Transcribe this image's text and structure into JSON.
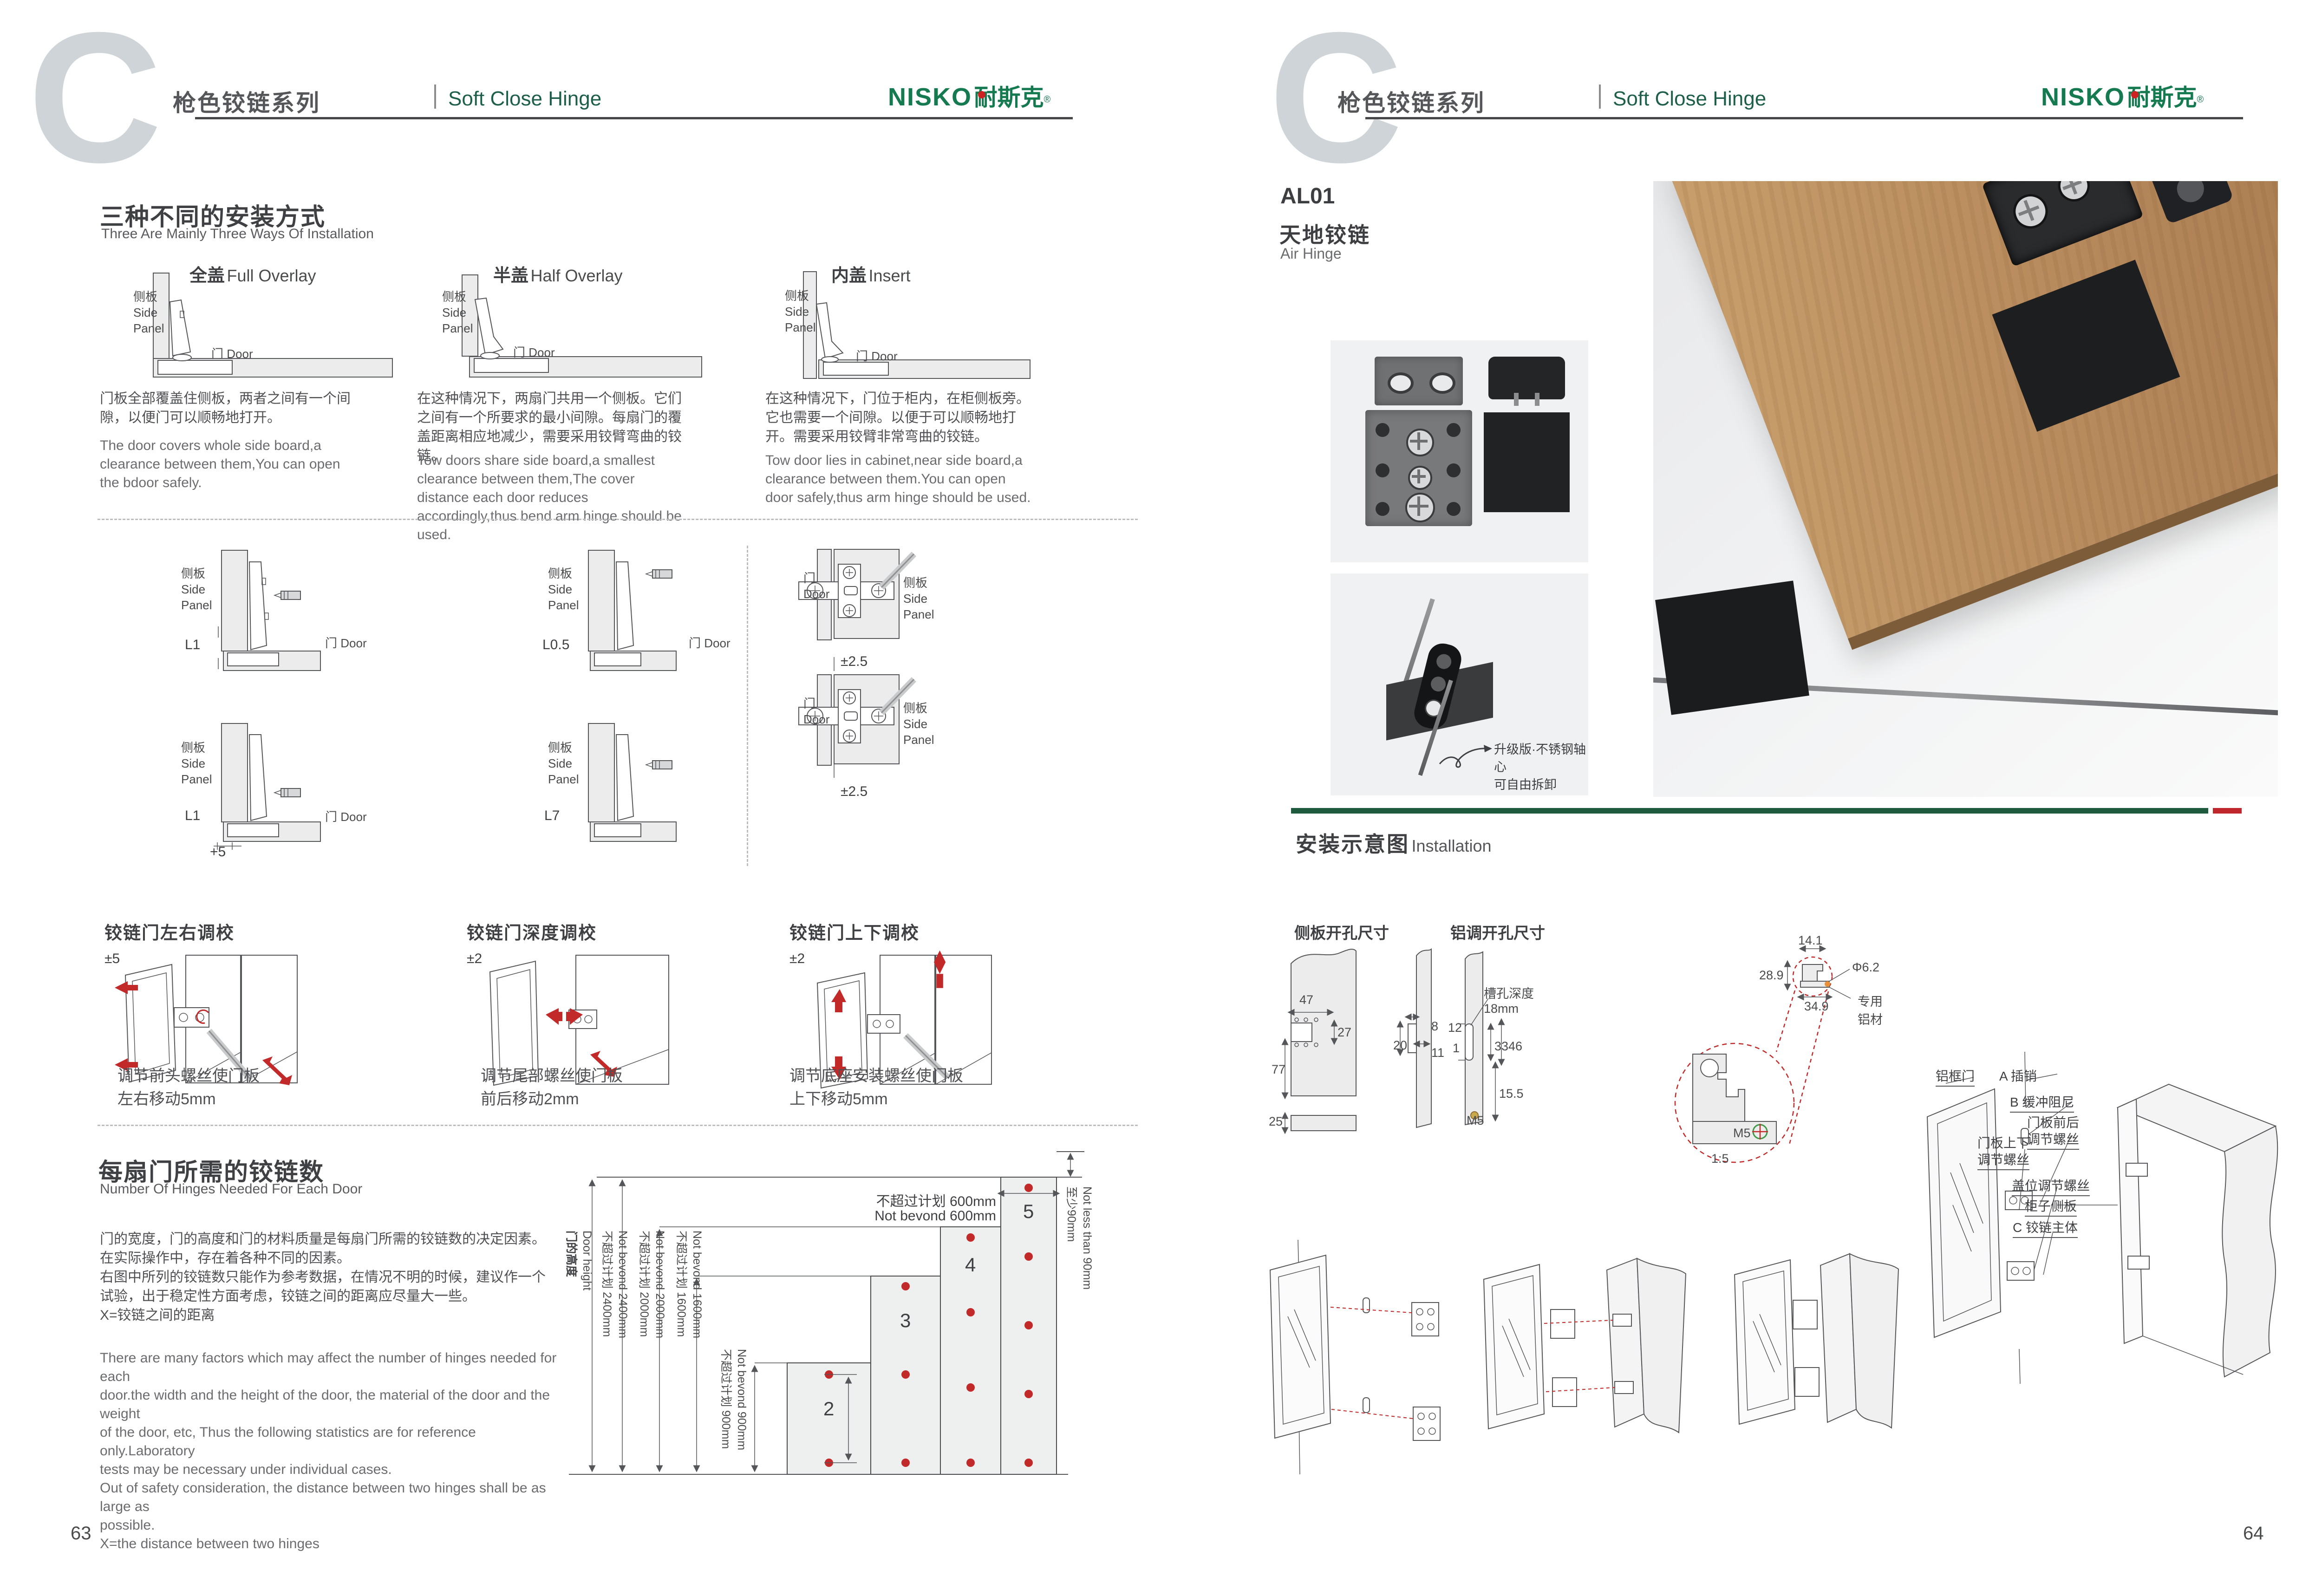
{
  "header": {
    "letter": "C",
    "title_cn": "枪色铰链系列",
    "title_en": "Soft Close Hinge",
    "brand_en": "NISKO",
    "brand_cn": "耐斯克",
    "brand_reg": "®"
  },
  "labels": {
    "side_panel_cn": "侧板",
    "side_panel_en1": "Side",
    "side_panel_en2": "Panel",
    "door_cn": "门",
    "door_en": "Door"
  },
  "install": {
    "title_cn": "三种不同的安装方式",
    "title_en": "Three Are Mainly Three Ways Of Installation",
    "methods": [
      {
        "title_cn": "全盖",
        "title_en": "Full Overlay",
        "desc_cn": "门板全部覆盖住侧板，两者之间有一个间隙，以便门可以顺畅地打开。",
        "desc_en": "The door covers whole side board,a clearance between them,You can open the bdoor safely."
      },
      {
        "title_cn": "半盖",
        "title_en": "Half Overlay",
        "desc_cn": "在这种情况下，两扇门共用一个侧板。它们之间有一个所要求的最小间隙。每扇门的覆盖距离相应地减少，需要采用铰臂弯曲的铰链。",
        "desc_en": "Tow doors share side board,a smallest clearance between them,The cover distance each door reduces accordingly,thus bend arm hinge should be used."
      },
      {
        "title_cn": "内盖",
        "title_en": "Insert",
        "desc_cn": "在这种情况下，门位于柜内，在柜侧板旁。它也需要一个间隙。以便于可以顺畅地打开。需要采用铰臂非常弯曲的铰链。",
        "desc_en": "Tow door lies in cabinet,near side board,a clearance between them.You can open door safely,thus arm hinge should be used."
      }
    ]
  },
  "clearance": {
    "l1": "L1",
    "l05": "L0.5",
    "l7": "L7",
    "plus5": "+5",
    "pm25": "±2.5"
  },
  "adjust": {
    "items": [
      {
        "title": "铰链门左右调校",
        "range": "±5",
        "cap1": "调节前头螺丝使门板",
        "cap2": "左右移动5mm"
      },
      {
        "title": "铰链门深度调校",
        "range": "±2",
        "cap1": "调节尾部螺丝使门板",
        "cap2": "前后移动2mm"
      },
      {
        "title": "铰链门上下调校",
        "range": "±2",
        "cap1": "调节底座安装螺丝使门板",
        "cap2": "上下移动5mm"
      }
    ]
  },
  "hinges": {
    "title_cn": "每扇门所需的铰链数",
    "title_en": "Number Of Hinges Needed For Each Door",
    "cn_lines": [
      "门的宽度，门的高度和门的材料质量是每扇门所需的铰链数的决定因素。",
      "在实际操作中，存在着各种不同的因素。",
      "右图中所列的铰链数只能作为参考数据，在情况不明的时候，建议作一个",
      "试验，出于稳定性方面考虑，铰链之间的距离应尽量大一些。",
      "X=铰链之间的距离"
    ],
    "en_lines": [
      "There are many factors which may affect the number of hinges needed for each",
      "door.the width and the height of the door, the material of the door and the weight",
      "of the door, etc, Thus the following statistics are for reference only.Laboratory",
      "tests may be necessary under individual cases.",
      "Out of safety consideration, the distance between two hinges shall be as large as",
      "possible.",
      "X=the distance between two hinges"
    ]
  },
  "chart": {
    "door_height_cn": "门的高度",
    "door_height_en": "Door height",
    "h2400_cn": "不超过计划 2400mm",
    "h2400_en": "Not bevond 2400mm",
    "h2000_cn": "不超过计划 2000mm",
    "h2000_en": "Not bevond 2000mm",
    "h1600_cn": "不超过计划 1600mm",
    "h1600_en": "Not bevond 1600mm",
    "h900_cn": "不超过计划 900mm",
    "h900_en": "Not bevond 900mm",
    "w600_cn": "不超过计划 600mm",
    "w600_en": "Not bevond 600mm",
    "min90_cn": "至少90mm",
    "min90_en": "Not less than 90mm",
    "n2": "2",
    "n3": "3",
    "n4": "4",
    "n5": "5"
  },
  "chart_data": {
    "type": "bar",
    "title": "Number Of Hinges Needed For Each Door",
    "categories": [
      "Not bevond 900mm",
      "Not bevond 1600mm",
      "Not bevond 2000mm",
      "Not bevond 2400mm"
    ],
    "values": [
      2,
      3,
      4,
      5
    ],
    "xlabel": "Door width not bevond 600mm",
    "ylabel": "Door height",
    "notes": [
      "Top hinge not less than 90mm from door edge",
      "X=the distance between two hinges"
    ]
  },
  "product": {
    "code": "AL01",
    "name_cn": "天地铰链",
    "name_en": "Air Hinge",
    "photo_note1": "升级版·不锈钢轴心",
    "photo_note2": "可自由拆卸"
  },
  "installation": {
    "title_cn": "安装示意图",
    "title_en": "Installation",
    "side_title": "侧板开孔尺寸",
    "alu_title": "铝调开孔尺寸",
    "d47": "47",
    "d27": "27",
    "d77": "77",
    "d25": "25",
    "d8": "8",
    "d20": "20",
    "d11": "11",
    "d12": "12",
    "d1": "1",
    "d33": "33",
    "d46": "46",
    "d155": "15.5",
    "m5": "M5",
    "slot_note1": "槽孔深度",
    "slot_note2": "18mm",
    "d141": "14.1",
    "d289": "28.9",
    "d349": "34.9",
    "dia62": "Φ6.2",
    "alu_mat1": "专用",
    "alu_mat2": "铝材",
    "scale": "1:5"
  },
  "explode": {
    "alu_door": "铝框门",
    "pin": "A 插销",
    "buffer": "B 缓冲阻尼",
    "fb1": "门板前后",
    "fb2": "调节螺丝",
    "ud1": "门板上下",
    "ud2": "调节螺丝",
    "cover": "盖位调节螺丝",
    "cab_side": "柜子侧板",
    "body": "C 铰链主体"
  },
  "pages": {
    "left": "63",
    "right": "64"
  }
}
